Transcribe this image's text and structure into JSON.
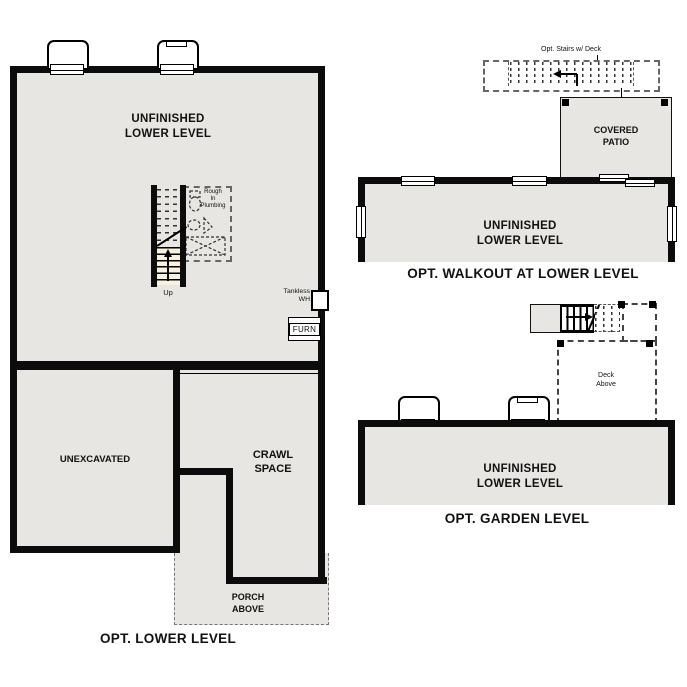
{
  "plans": {
    "lower_level": {
      "caption": "OPT. LOWER LEVEL",
      "main_room": "UNFINISHED\nLOWER LEVEL",
      "unexcavated": "UNEXCAVATED",
      "crawl_space": "CRAWL\nSPACE",
      "porch": "PORCH\nABOVE",
      "up": "Up",
      "rough_in": "Rough\nIn\nPlumbing",
      "tankless": "Tankless\nWH",
      "furnace": "FURN"
    },
    "walkout": {
      "caption": "OPT. WALKOUT AT LOWER LEVEL",
      "main_room": "UNFINISHED\nLOWER LEVEL",
      "covered_patio": "COVERED\nPATIO",
      "opt_stairs": "Opt. Stairs w/ Deck"
    },
    "garden": {
      "caption": "OPT. GARDEN LEVEL",
      "main_room": "UNFINISHED\nLOWER LEVEL",
      "deck": "Deck\nAbove"
    }
  },
  "colors": {
    "floor": "#e7e6e3",
    "wall": "#0c0c0c",
    "stair_tread": "#f7f1df",
    "dashed_line": "#555555"
  }
}
